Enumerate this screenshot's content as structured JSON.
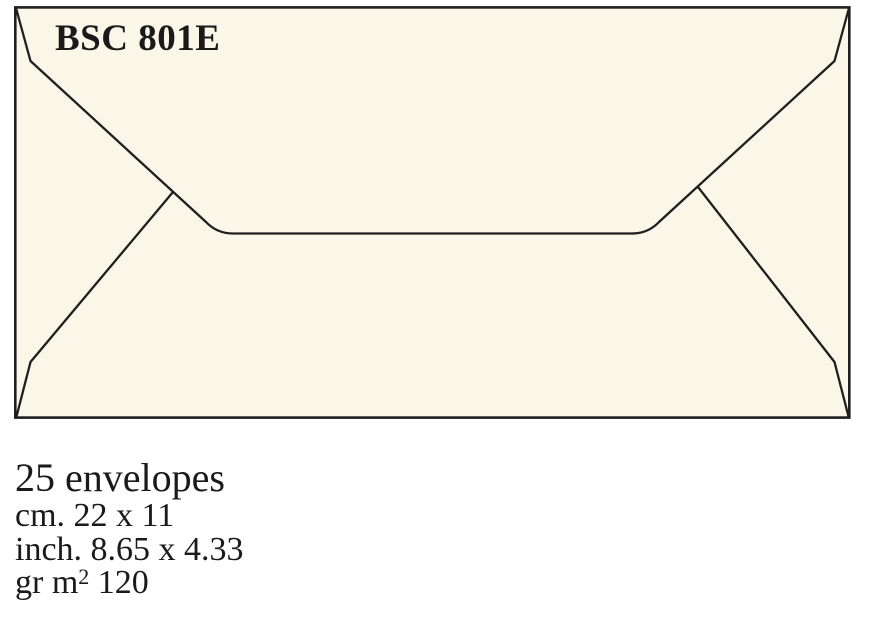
{
  "colors": {
    "envelope_fill": "#FAF7E8",
    "line": "#1f1f1f",
    "text": "#1a1a1a",
    "background": "#ffffff"
  },
  "envelope": {
    "model": "BSC 801E"
  },
  "specs": {
    "quantity": "25 envelopes",
    "size_cm": "cm. 22 x 11",
    "size_inch": "inch. 8.65 x 4.33",
    "grammage_prefix": "gr m",
    "grammage_sup": "2",
    "grammage_value": " 120"
  }
}
